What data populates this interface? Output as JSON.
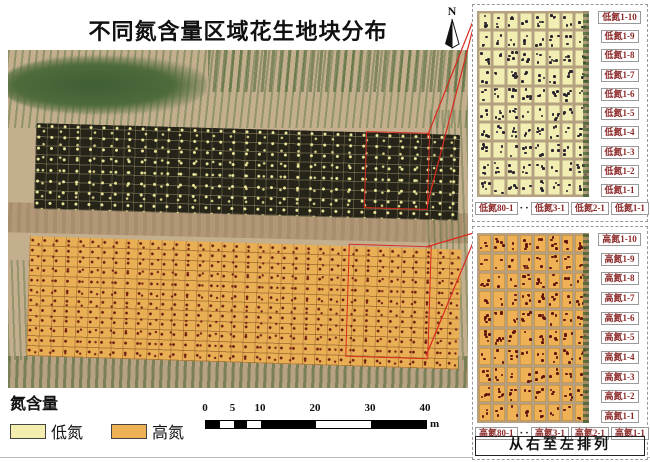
{
  "title": "不同氮含量区域花生地块分布",
  "north": "N",
  "legend": {
    "heading": "氮含量",
    "items": [
      {
        "label": "低氮",
        "color": "#f3eeae"
      },
      {
        "label": "高氮",
        "color": "#eeb156"
      }
    ]
  },
  "scalebar": {
    "ticks": [
      "0",
      "5",
      "10",
      "20",
      "30",
      "40"
    ],
    "unit": "m"
  },
  "map": {
    "low_strip_color": "#262418",
    "low_speckle_color": "#ece79b",
    "high_strip_color": "#e9af54",
    "high_speckle_color": "#6b1d12",
    "extent_color": "#d92b1f"
  },
  "insets": [
    {
      "id": "low",
      "row_labels": [
        "低氮1-10",
        "低氮1-9",
        "低氮1-8",
        "低氮1-7",
        "低氮1-6",
        "低氮1-5",
        "低氮1-4",
        "低氮1-3",
        "低氮1-2",
        "低氮1-1"
      ],
      "col_labels": [
        "低氮80-1",
        "·",
        "·",
        "低氮3-1",
        "低氮2-1",
        "低氮1-1"
      ],
      "plot_color": "#f2edb2",
      "dot_color": "#2a2430",
      "soil_color": "#b5a081"
    },
    {
      "id": "high",
      "row_labels": [
        "高氮1-10",
        "高氮1-9",
        "高氮1-8",
        "高氮1-7",
        "高氮1-6",
        "高氮1-5",
        "高氮1-4",
        "高氮1-3",
        "高氮1-2",
        "高氮1-1"
      ],
      "col_labels": [
        "高氮80-1",
        "·",
        "·",
        "高氮3-1",
        "高氮2-1",
        "高氮1-1"
      ],
      "plot_color": "#eeb156",
      "dot_color": "#5f1410",
      "soil_color": "#b5a081"
    }
  ],
  "footer_note": "从右至左排列",
  "label_text_color": "#8b2727"
}
